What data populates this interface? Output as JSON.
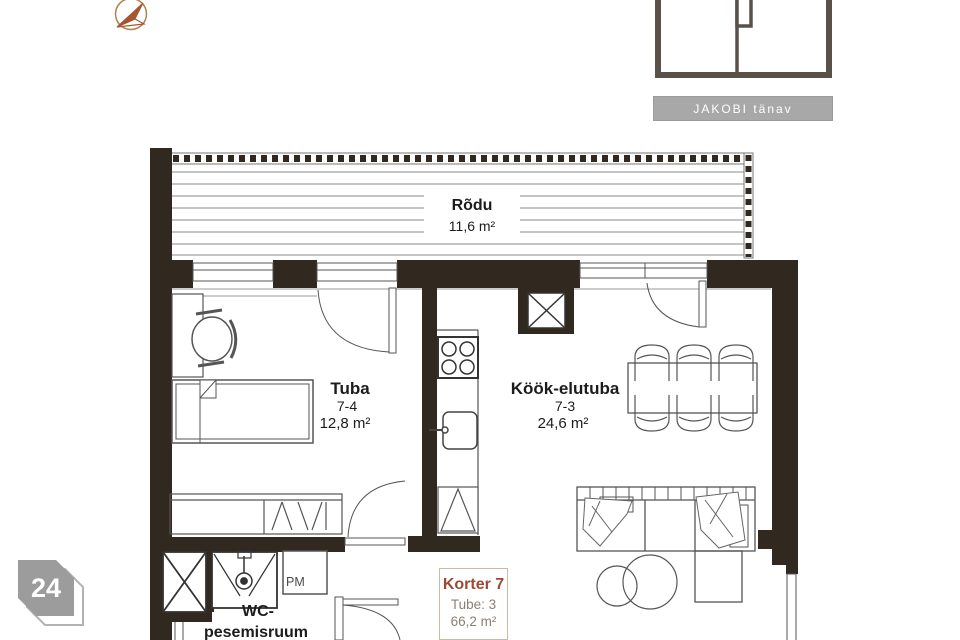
{
  "labels": {
    "balcony": {
      "name": "Rõdu",
      "area": "11,6 m²"
    },
    "bedroom": {
      "name": "Tuba",
      "number": "7-4",
      "area": "12,8 m²"
    },
    "kitchen_living": {
      "name": "Köök-elutuba",
      "number": "7-3",
      "area": "24,6 m²"
    },
    "bathroom": {
      "line1": "WC-",
      "line2": "pesemisruum"
    },
    "washing_machine": "PM"
  },
  "apartment_card": {
    "title": "Korter 7",
    "rooms": "Tube: 3",
    "area": "66,2 m²"
  },
  "street_sign": {
    "text": "JAKOBI tänav"
  },
  "page_badge": {
    "number": "24"
  },
  "colors": {
    "wall": "#31281f",
    "furniture_line": "#555555",
    "deck_line": "#8a8a8a",
    "accent_brown": "#9d4937",
    "card_border": "#ccbaa3",
    "card_text": "#8b8076",
    "street_bg": "#a8a8a8",
    "badge_bg": "#9c9c9c",
    "compass": "#a5562e",
    "minimap_wall": "#5a5148"
  }
}
